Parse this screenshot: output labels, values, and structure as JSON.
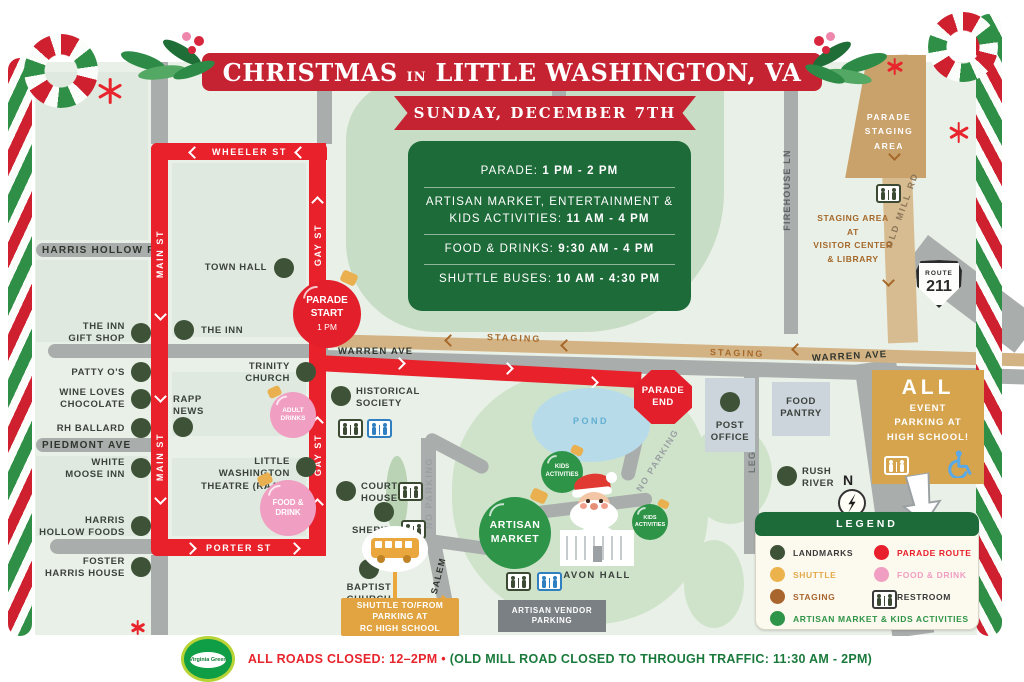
{
  "banner": {
    "title_left": "CHRISTMAS",
    "title_in": "IN",
    "title_right": "LITTLE WASHINGTON, VA",
    "date": "SUNDAY, DECEMBER 7TH"
  },
  "schedule": [
    {
      "label": "PARADE:",
      "time": "1 PM - 2 PM"
    },
    {
      "label": "ARTISAN MARKET, ENTERTAINMENT & KIDS ACTIVITIES:",
      "time": "11 AM - 4 PM"
    },
    {
      "label": "FOOD & DRINKS:",
      "time": "9:30 AM - 4 PM"
    },
    {
      "label": "SHUTTLE BUSES:",
      "time": "10 AM - 4:30 PM"
    }
  ],
  "streets": {
    "wheeler": "WHEELER ST",
    "main": "MAIN ST",
    "gay": "GAY ST",
    "porter": "PORTER ST",
    "warren": "WARREN AVE",
    "harris_hollow": "HARRIS HOLLOW RD",
    "piedmont": "PIEDMONT AVE",
    "leggett": "LEGGETT LANE",
    "firehouse": "FIREHOUSE LN",
    "old_mill": "OLD MILL RD",
    "mt_salem": "MT SALEM",
    "no_parking": "NO PARKING",
    "staging": "STAGING"
  },
  "landmarks": {
    "town_hall": "TOWN HALL",
    "the_inn": "THE INN",
    "inn_gift_shop": "THE INN\nGIFT SHOP",
    "patty_os": "PATTY O'S",
    "wine_loves_chocolate": "WINE LOVES\nCHOCOLATE",
    "rh_ballard": "RH BALLARD",
    "rapp_news": "RAPP\nNEWS",
    "white_moose_inn": "WHITE\nMOOSE INN",
    "harris_hollow_foods": "HARRIS\nHOLLOW FOODS",
    "foster_harris_house": "FOSTER\nHARRIS HOUSE",
    "trinity_church": "TRINITY\nCHURCH",
    "little_washington_theatre": "LITTLE WASHINGTON\nTHEATRE (RAAC)",
    "historical_society": "HISTORICAL\nSOCIETY",
    "court_house": "COURT\nHOUSE",
    "sheriff": "SHERIFF",
    "baptist_church": "BAPTIST\nCHURCH",
    "rush_river": "RUSH\nRIVER",
    "post_office": "POST\nOFFICE",
    "food_pantry": "FOOD\nPANTRY",
    "avon_hall": "AVON HALL"
  },
  "markers": {
    "parade_start": "PARADE\nSTART",
    "parade_start_time": "1 PM",
    "parade_end": "PARADE\nEND",
    "adult_drinks": "ADULT\nDRINKS",
    "food_drink": "FOOD &\nDRINK",
    "kids_activities": "KIDS\nACTIVITIES",
    "artisan_market": "ARTISAN\nMARKET"
  },
  "areas": {
    "parade_staging": "PARADE\nSTAGING\nAREA",
    "staging_note": "STAGING AREA\nAT\nVISITOR CENTER\n& LIBRARY",
    "vendor_parking": "ARTISAN VENDOR\nPARKING",
    "parking_all": "ALL",
    "parking_rest": "EVENT\nPARKING AT\nHIGH SCHOOL!",
    "shuttle_note": "SHUTTLE TO/FROM\nPARKING AT\nRC HIGH SCHOOL",
    "pond": "POND",
    "route_word": "ROUTE",
    "route_num": "211",
    "compass": "N"
  },
  "legend": {
    "title": "LEGEND",
    "items": [
      {
        "label": "LANDMARKS",
        "color": "#3e5238",
        "text_color": "#3a3a3a"
      },
      {
        "label": "SHUTTLE",
        "color": "#ecb34c",
        "text_color": "#e3a94b"
      },
      {
        "label": "STAGING",
        "color": "#a8652d",
        "text_color": "#a8652d"
      },
      {
        "label": "ARTISAN MARKET & KIDS ACTIVITIES",
        "color": "#2e9447",
        "text_color": "#2e9447"
      },
      {
        "label": "PARADE ROUTE",
        "color": "#e8202b",
        "text_color": "#e8202b"
      },
      {
        "label": "FOOD & DRINK",
        "color": "#f09ec2",
        "text_color": "#f09ec2"
      },
      {
        "label": "RESTROOM",
        "color": "#3a3a3a",
        "text_color": "#3a3a3a"
      }
    ]
  },
  "footer": {
    "closed_red": "ALL ROADS CLOSED: 12–2PM",
    "bullet": "•",
    "closed_green": "(OLD MILL ROAD CLOSED TO THROUGH TRAFFIC: 11:30 AM - 2PM)",
    "logo": "Virginia Green"
  },
  "colors": {
    "parade_route": "#e8212b",
    "staging_road": "#d8bc91",
    "landmark": "#3e5238",
    "artisan_green": "#2e9447",
    "food_pink": "#f09ec2",
    "shuttle_gold": "#eab04f",
    "banner_red": "#c52232",
    "schedule_green": "#1e6b3a"
  }
}
